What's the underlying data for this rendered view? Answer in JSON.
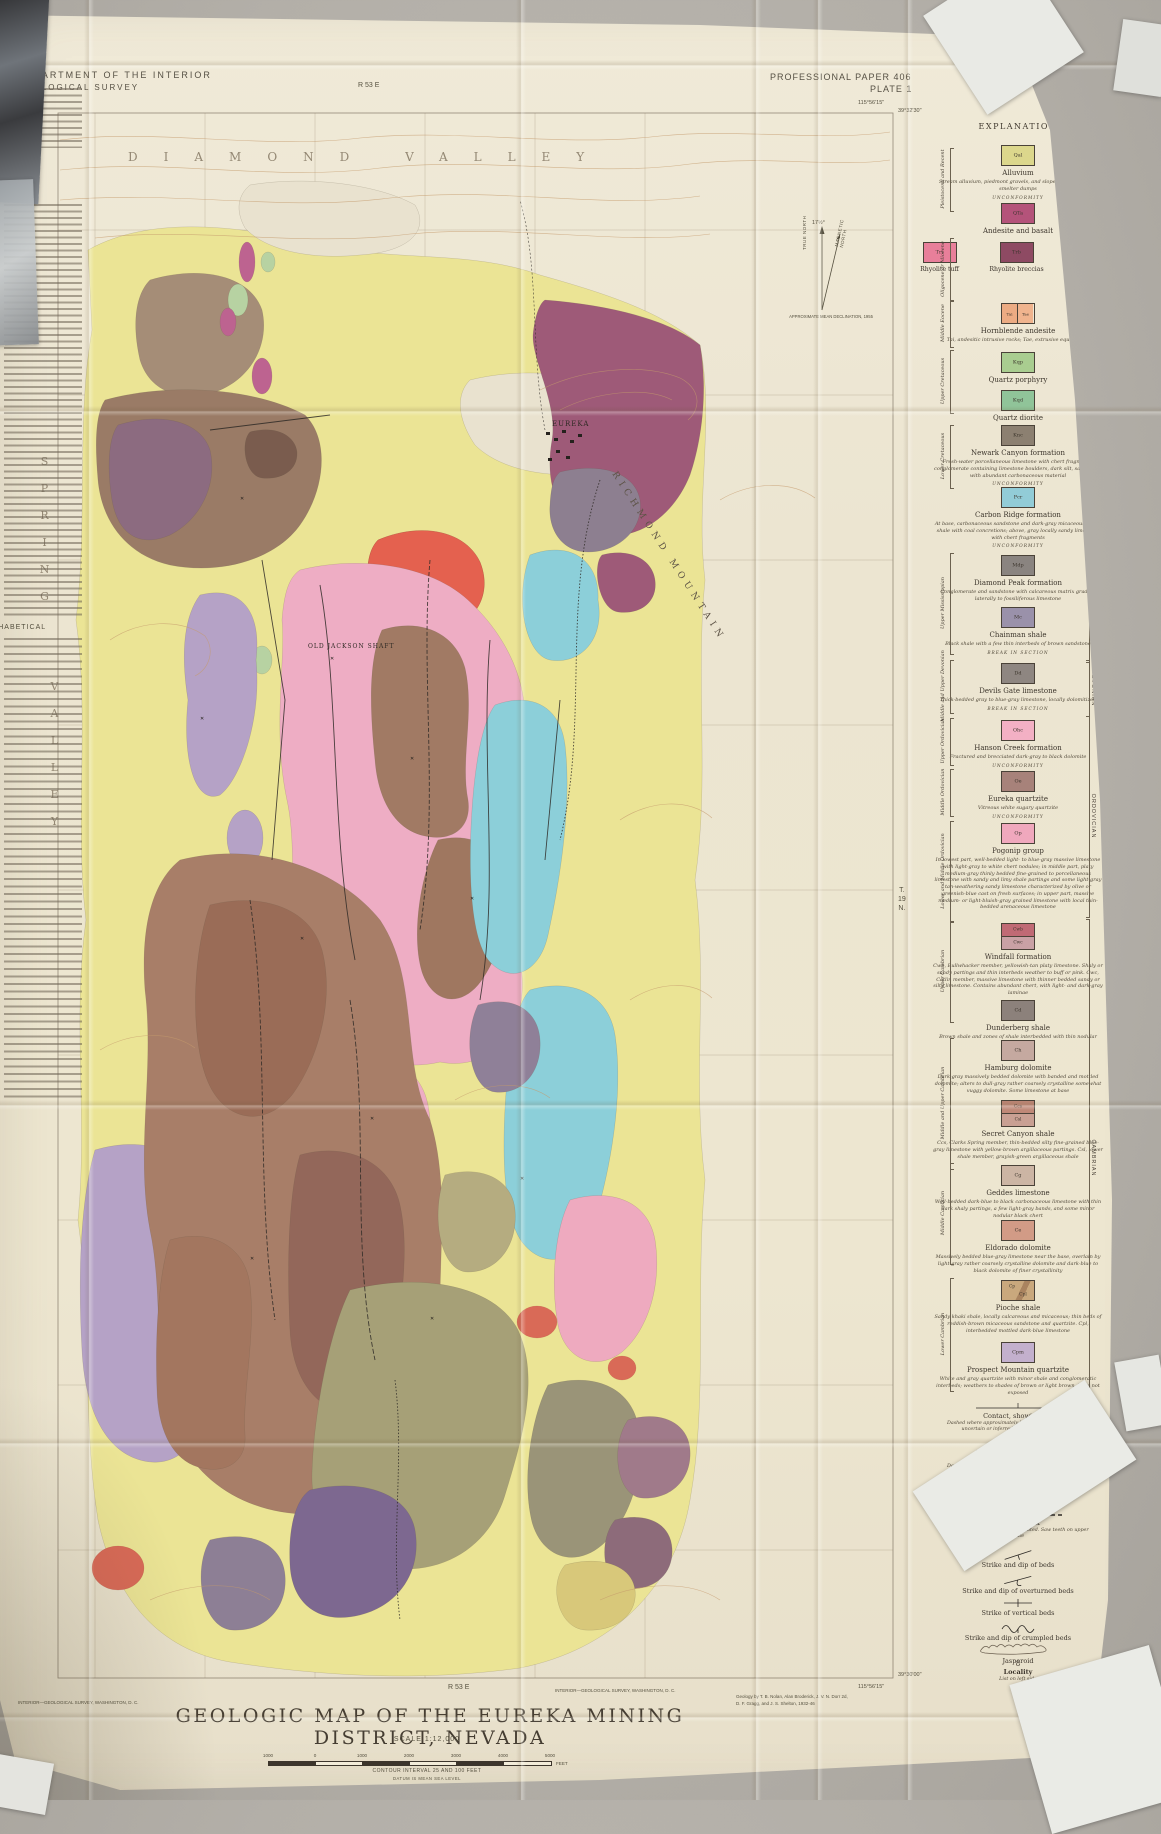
{
  "photo": {
    "background": "#b3afa8",
    "paper": "#ece5d1"
  },
  "header": {
    "agency_line1": "DEPARTMENT OF THE INTERIOR",
    "agency_line2": "GEOLOGICAL SURVEY",
    "paper_no": "PROFESSIONAL PAPER 406",
    "plate": "PLATE 1"
  },
  "left_panel": {
    "heading_line1": "MINES AND NUMBERED",
    "heading_line2": "LOCALITIES",
    "subheading": "ALPHABETICAL"
  },
  "map": {
    "labels": {
      "valley_top": "DIAMOND VALLEY",
      "valley_left_1": "SPRING",
      "valley_left_2": "VALLEY",
      "mountain": "RICHMOND MOUNTAIN",
      "town": "EUREKA",
      "shaft": "OLD JACKSON SHAFT",
      "township_1": "T.",
      "township_2": "19",
      "township_3": "N.",
      "range_top": "R 53 E",
      "range_bottom": "R 53 E",
      "corner_tr_lon": "115°56'15\"",
      "corner_tr_lat": "39°32'30\"",
      "corner_br_lat": "39°30'00\"",
      "corner_br_lon": "115°56'15\""
    },
    "declination": {
      "angle": "17½°",
      "true_north": "TRUE NORTH",
      "magnetic_north": "MAGNETIC NORTH",
      "note": "APPROXIMATE MEAN DECLINATION, 1955"
    }
  },
  "legend": {
    "title": "EXPLANATION",
    "eras": [
      "QUATERNARY",
      "TERTIARY",
      "CRETACEOUS",
      "PERMIAN",
      "MISSISSIPPIAN",
      "DEVONIAN",
      "ORDOVICIAN",
      "CAMBRIAN"
    ],
    "ages": [
      "Pleistocene and Recent",
      "Oligocene or Miocene",
      "Middle Eocene",
      "Upper Cretaceous",
      "Lower Cretaceous",
      "Upper Mississippian",
      "Middle and Upper Devonian",
      "Upper Ordovician",
      "Middle Ordovician",
      "Lower and Middle Ordovician",
      "Upper Cambrian",
      "Middle and Upper Cambrian",
      "Middle Cambrian",
      "Lower Cambrian"
    ],
    "units": [
      {
        "type": "single",
        "boxes": [
          {
            "code": "Qal",
            "color": "#dcd78c"
          }
        ],
        "name": "Alluvium",
        "desc": "Stream alluvium, piedmont gravels, and slope wash; mine and smelter dumps",
        "sep": "UNCONFORMITY"
      },
      {
        "type": "single",
        "boxes": [
          {
            "code": "QTa",
            "color": "#b4537a"
          }
        ],
        "name": "Andesite and basalt",
        "desc": "",
        "sep": ""
      },
      {
        "type": "row",
        "items": [
          {
            "code": "Trt",
            "color": "#e87f9a",
            "name": "Rhyolite tuff",
            "note": ""
          },
          {
            "code": "Trb",
            "color": "#8e4a63",
            "name": "Rhyolite breccias",
            "note": ""
          },
          {
            "code": "Trp",
            "color": "#c0794f",
            "name": "Rhyolite plugs, dikes, and flows",
            "note": "Trr, rhyolite vitrophyre"
          }
        ]
      },
      {
        "type": "pair",
        "boxes": [
          {
            "code": "Tai",
            "color": "#ecab83"
          },
          {
            "code": "Tae",
            "color": "#f0b48e"
          }
        ],
        "name": "Hornblende andesite",
        "desc": "Tai, andesitic intrusive rocks; Tae, extrusive equivalents",
        "sep": ""
      },
      {
        "type": "single",
        "boxes": [
          {
            "code": "Kqp",
            "color": "#a9cd90"
          }
        ],
        "name": "Quartz porphyry",
        "desc": "",
        "sep": ""
      },
      {
        "type": "single",
        "boxes": [
          {
            "code": "Kqd",
            "color": "#90c499"
          }
        ],
        "name": "Quartz diorite",
        "desc": "",
        "sep": ""
      },
      {
        "type": "single",
        "boxes": [
          {
            "code": "Knc",
            "color": "#8c8071"
          }
        ],
        "name": "Newark Canyon formation",
        "desc": "Fresh-water porcellaneous limestone with chert fragments, conglomerate containing limestone boulders, dark silt, sandstone, with abundant carbonaceous material",
        "sep": "UNCONFORMITY"
      },
      {
        "type": "single",
        "boxes": [
          {
            "code": "Pcr",
            "color": "#92ccd7"
          }
        ],
        "name": "Carbon Ridge formation",
        "desc": "At base, carbonaceous sandstone and dark-gray micaceous sandy shale with coal concretions; above, gray locally sandy limestone with chert fragments",
        "sep": "UNCONFORMITY"
      },
      {
        "type": "single",
        "boxes": [
          {
            "code": "Mdp",
            "color": "#8a8480"
          }
        ],
        "name": "Diamond Peak formation",
        "desc": "Conglomerate and sandstone with calcareous matrix grading laterally to fossiliferous limestone",
        "sep": ""
      },
      {
        "type": "single",
        "boxes": [
          {
            "code": "Mc",
            "color": "#9a91aa"
          }
        ],
        "name": "Chainman shale",
        "desc": "Black shale with a few thin interbeds of brown sandstone",
        "sep": "BREAK IN SECTION"
      },
      {
        "type": "single",
        "boxes": [
          {
            "code": "Dd",
            "color": "#8e8681"
          }
        ],
        "name": "Devils Gate limestone",
        "desc": "Thick-bedded gray to blue-gray limestone, locally dolomitized",
        "sep": "BREAK IN SECTION"
      },
      {
        "type": "single",
        "boxes": [
          {
            "code": "Ohc",
            "color": "#f3b0c4"
          }
        ],
        "name": "Hanson Creek formation",
        "desc": "Fractured and brecciated dark-gray to black dolomite",
        "sep": "UNCONFORMITY"
      },
      {
        "type": "single",
        "boxes": [
          {
            "code": "Oe",
            "color": "#a7827a"
          }
        ],
        "name": "Eureka quartzite",
        "desc": "Vitreous white sugary quartzite",
        "sep": "UNCONFORMITY"
      },
      {
        "type": "single",
        "boxes": [
          {
            "code": "Op",
            "color": "#f0a8bd"
          }
        ],
        "name": "Pogonip group",
        "desc": "In lowest part, well-bedded light- to blue-gray massive limestone with light-gray to white chert nodules; in middle part, platy medium-gray thinly bedded fine-grained to porcellaneous limestone with sandy and limy shale partings and some light-gray tan-weathering sandy limestone characterized by olive or greenish-blue cast on fresh surfaces; in upper part, massive medium- or light-bluish-gray grained limestone with local thin-bedded arenaceous limestone",
        "sep": ""
      },
      {
        "type": "stack",
        "boxes": [
          {
            "code": "Cwb",
            "color": "#c06a75"
          },
          {
            "code": "Cwc",
            "color": "#c9a1a5"
          }
        ],
        "name": "Windfall formation",
        "desc": "Cwb, Bullwhacker member, yellowish-tan platy limestone. Shaly or sandy partings and thin interbeds weather to buff or pink. Cwc, Catlin member, massive limestone with thinner bedded sandy or silty limestone. Contains abundant chert, with light- and dark-gray laminae",
        "sep": ""
      },
      {
        "type": "single",
        "boxes": [
          {
            "code": "Cd",
            "color": "#8c817b"
          }
        ],
        "name": "Dunderberg shale",
        "desc": "Brown shale and zones of shale interbedded with thin nodular limestone",
        "sep": ""
      },
      {
        "type": "single",
        "boxes": [
          {
            "code": "Ch",
            "color": "#c5a9a0"
          }
        ],
        "name": "Hamburg dolomite",
        "desc": "Dark-gray massively bedded dolomite with banded and mottled dolomite; alters to dull-gray rather coarsely crystalline somewhat vuggy dolomite. Some limestone at base",
        "sep": ""
      },
      {
        "type": "stack",
        "boxes": [
          {
            "code": "Ccs",
            "color": "#bf8877"
          },
          {
            "code": "Csl",
            "color": "#c9a093"
          }
        ],
        "name": "Secret Canyon shale",
        "desc": "Ccs, Clarks Spring member, thin-bedded silty fine-grained blue-gray limestone with yellow-brown argillaceous partings. Csl, lower shale member, grayish-green argillaceous shale",
        "sep": ""
      },
      {
        "type": "single",
        "boxes": [
          {
            "code": "Cg",
            "color": "#ccb5a4"
          }
        ],
        "name": "Geddes limestone",
        "desc": "Well-bedded dark-blue to black carbonaceous limestone with thin dark shaly partings, a few light-gray bands, and some minor nodular black chert",
        "sep": ""
      },
      {
        "type": "single",
        "boxes": [
          {
            "code": "Ce",
            "color": "#d29b86"
          }
        ],
        "name": "Eldorado dolomite",
        "desc": "Massively bedded blue-gray limestone near the base, overlain by light-gray rather coarsely crystalline dolomite and dark-blue to black dolomite of finer crystallinity",
        "sep": ""
      },
      {
        "type": "diag",
        "boxes": [
          {
            "code": "Cp",
            "color": "#c9a87d"
          },
          {
            "code": "Cpl",
            "color": "#a9835f"
          }
        ],
        "name": "Pioche shale",
        "desc": "Sandy khaki shale, locally calcareous and micaceous; thin beds of reddish-brown micaceous sandstone and quartzite. Cpl, interbedded mottled dark-blue limestone",
        "sep": ""
      },
      {
        "type": "single",
        "boxes": [
          {
            "code": "Cpm",
            "color": "#c3b0cd"
          }
        ],
        "name": "Prospect Mountain quartzite",
        "desc": "White and gray quartzite with minor shale and conglomeratic interbeds; weathers to shades of brown or light brown. Base not exposed",
        "sep": ""
      }
    ],
    "symbols": [
      {
        "kind": "contact",
        "name": "Contact, showing dip",
        "desc": "Dashed where approximately located; short dashed where uncertain or inferred; dotted where concealed"
      },
      {
        "kind": "fault",
        "name": "Fault, showing dip",
        "desc": "Dashed where approximately located; short dashed where uncertain or inferred; dotted where concealed"
      },
      {
        "kind": "fault-move",
        "name": "Fault showing relative movement",
        "desc": ""
      },
      {
        "kind": "thrust",
        "name": "Thrust fault",
        "desc": "Dashed where approximately located. Saw teeth on upper plate"
      },
      {
        "kind": "strike-dip",
        "name": "Strike and dip of beds",
        "desc": ""
      },
      {
        "kind": "overturned",
        "name": "Strike and dip of overturned beds",
        "desc": ""
      },
      {
        "kind": "vertical",
        "name": "Strike of vertical beds",
        "desc": ""
      },
      {
        "kind": "crumpled",
        "name": "Strike and dip of crumpled beds",
        "desc": ""
      },
      {
        "kind": "jasperoid",
        "name": "Jasperoid",
        "desc": ""
      },
      {
        "kind": "locality",
        "name": "Locality",
        "desc": "List on left side",
        "number": "8"
      }
    ]
  },
  "footer": {
    "title": "GEOLOGIC MAP OF THE EUREKA MINING DISTRICT, NEVADA",
    "scale": "SCALE 1:12,000",
    "scale_bar_labels": [
      "1000",
      "0",
      "1000",
      "2000",
      "3000",
      "4000",
      "5000"
    ],
    "scale_bar_unit": "FEET",
    "contour": "CONTOUR INTERVAL 25 AND 100 FEET",
    "datum": "DATUM IS MEAN SEA LEVEL",
    "credit_line1": "Geology by T. B. Nolan, Alan Broderick, J. V. N. Dorr 2d,",
    "credit_line2": "D. F. Gragg, and J. S. Shelton, 1932-46",
    "printer": "INTERIOR—GEOLOGICAL SURVEY, WASHINGTON, D. C."
  }
}
